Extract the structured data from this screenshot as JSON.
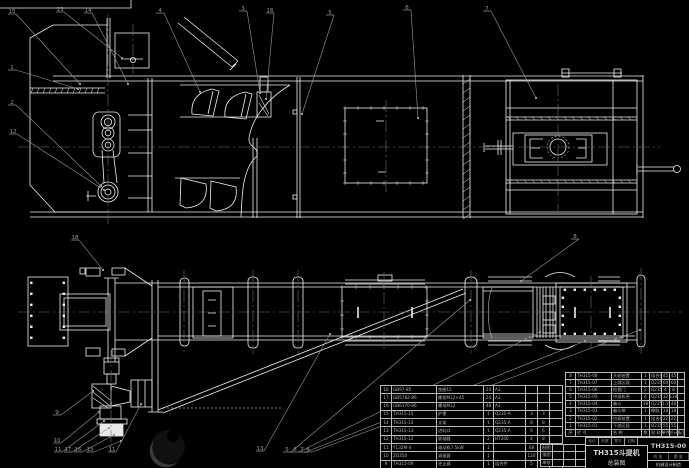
{
  "colors": {
    "background": "#000000",
    "line": "#f0f0f0",
    "aux": "#9a9a9a",
    "centerline": "#6f6f6f",
    "table_line": "#b9b9b9",
    "table_text": "#b5b5b5",
    "watermark_dark": "#101010",
    "watermark_light": "#3a3a3a"
  },
  "title_block": {
    "product": "TH315斗提机",
    "sheet_name": "总装图",
    "drawing_no": "TH315-00",
    "org": "机械设计制造",
    "sheet_count": "共 张",
    "sheet_index": "第 张",
    "top_strip": [
      "标记",
      "处数",
      "签字",
      "日期",
      ""
    ],
    "sig_rows": [
      [
        "制图",
        "",
        "",
        ""
      ],
      [
        "描图",
        "",
        "",
        ""
      ],
      [
        "审核",
        "",
        "",
        ""
      ]
    ]
  },
  "bom": {
    "headers": [
      "序",
      "代  号",
      "名  称",
      "数",
      "材  料",
      "单件",
      "总计",
      "备注"
    ],
    "left_rows": [
      [
        "18",
        "GB97-85",
        "垫圈12",
        "24",
        "A3",
        "",
        "",
        ""
      ],
      [
        "17",
        "GB5782-86",
        "螺栓M12×45",
        "24",
        "A3",
        "",
        "",
        ""
      ],
      [
        "16",
        "GB6170-86",
        "螺母M12",
        "48",
        "A3",
        "",
        "",
        ""
      ],
      [
        "15",
        "TH315-15",
        "护罩",
        "1",
        "Q235-A",
        "3",
        "3",
        ""
      ],
      [
        "14",
        "TH315-14",
        "支架",
        "1",
        "Q235-A",
        "8",
        "8",
        ""
      ],
      [
        "13",
        "TH315-13",
        "进料口",
        "1",
        "Q235-A",
        "6",
        "6",
        ""
      ],
      [
        "12",
        "TH315-12",
        "联轴器",
        "2",
        "HT200",
        "4",
        "8",
        ""
      ],
      [
        "11",
        "Y132M-4",
        "电动机7.5kW",
        "1",
        "",
        "68",
        "68",
        "外购"
      ],
      [
        "10",
        "ZQ350",
        "减速器",
        "1",
        "",
        "120",
        "120",
        "外购"
      ],
      [
        "9",
        "TH315-09",
        "逆止器",
        "1",
        "组合件",
        "5",
        "5",
        ""
      ]
    ],
    "right_rows": [
      [
        "8",
        "TH315-08",
        "头轮装置",
        "1",
        "组合件",
        "45",
        "45",
        ""
      ],
      [
        "7",
        "TH315-07",
        "上部区段",
        "1",
        "Q235-A",
        "60",
        "60",
        ""
      ],
      [
        "6",
        "TH315-06",
        "检视门",
        "2",
        "Q235-A",
        "4",
        "8",
        ""
      ],
      [
        "5",
        "TH315-05",
        "中部机壳",
        "4",
        "Q235-A",
        "32",
        "128",
        ""
      ],
      [
        "4",
        "TH315-04",
        "畚斗",
        "38",
        "Q235-A",
        "1.2",
        "46",
        ""
      ],
      [
        "3",
        "TH315-03",
        "畚斗带",
        "1",
        "橡胶",
        "18",
        "18",
        ""
      ],
      [
        "2",
        "TH315-02",
        "拉紧装置",
        "1",
        "组合件",
        "22",
        "22",
        ""
      ],
      [
        "1",
        "TH315-01",
        "下部区段",
        "1",
        "Q235-A",
        "55",
        "55",
        ""
      ]
    ]
  },
  "balloons": [
    {
      "n": "15",
      "x": 12,
      "y": 12,
      "tx": 80,
      "ty": 84
    },
    {
      "n": "13",
      "x": 60,
      "y": 10,
      "tx": 122,
      "ty": 58
    },
    {
      "n": "14",
      "x": 88,
      "y": 11,
      "tx": 128,
      "ty": 84
    },
    {
      "n": "4",
      "x": 160,
      "y": 11,
      "tx": 200,
      "ty": 92
    },
    {
      "n": "3",
      "x": 243,
      "y": 9,
      "tx": 260,
      "ty": 93
    },
    {
      "n": "16",
      "x": 270,
      "y": 11,
      "tx": 266,
      "ty": 99
    },
    {
      "n": "5",
      "x": 330,
      "y": 13,
      "tx": 302,
      "ty": 114
    },
    {
      "n": "6",
      "x": 407,
      "y": 8,
      "tx": 418,
      "ty": 118
    },
    {
      "n": "7",
      "x": 487,
      "y": 9,
      "tx": 536,
      "ty": 98
    },
    {
      "n": "1",
      "x": 12,
      "y": 68,
      "tx": 78,
      "ty": 89
    },
    {
      "n": "2",
      "x": 12,
      "y": 103,
      "tx": 101,
      "ty": 186
    },
    {
      "n": "12",
      "x": 13,
      "y": 132,
      "tx": 104,
      "ty": 190
    },
    {
      "n": "18",
      "x": 75,
      "y": 238,
      "tx": 103,
      "ty": 270
    },
    {
      "n": "8",
      "x": 575,
      "y": 237,
      "tx": 521,
      "ty": 281
    },
    {
      "n": "9",
      "x": 57,
      "y": 413,
      "tx": 93,
      "ty": 391
    },
    {
      "n": "10",
      "x": 57,
      "y": 441,
      "tx": 99,
      "ty": 412
    },
    {
      "n": "11",
      "x": 58,
      "y": 450,
      "tx": 104,
      "ty": 421
    },
    {
      "n": "17",
      "x": 68,
      "y": 450,
      "tx": 109,
      "ty": 428
    },
    {
      "n": "16",
      "x": 78,
      "y": 450,
      "tx": 114,
      "ty": 435
    },
    {
      "n": "15",
      "x": 90,
      "y": 450,
      "tx": 121,
      "ty": 441
    },
    {
      "n": "11",
      "x": 112,
      "y": 450,
      "tx": 141,
      "ty": 404
    },
    {
      "n": "13",
      "x": 260,
      "y": 449,
      "tx": 330,
      "ty": 334
    },
    {
      "n": "5",
      "x": 287,
      "y": 450,
      "tx": 470,
      "ty": 300
    },
    {
      "n": "6",
      "x": 295,
      "y": 450,
      "tx": 540,
      "ty": 332
    },
    {
      "n": "7",
      "x": 302,
      "y": 450,
      "tx": 585,
      "ty": 341
    },
    {
      "n": "4",
      "x": 308,
      "y": 450,
      "tx": 640,
      "ty": 330
    }
  ],
  "watermark": {
    "shape": "crescent-logo"
  }
}
